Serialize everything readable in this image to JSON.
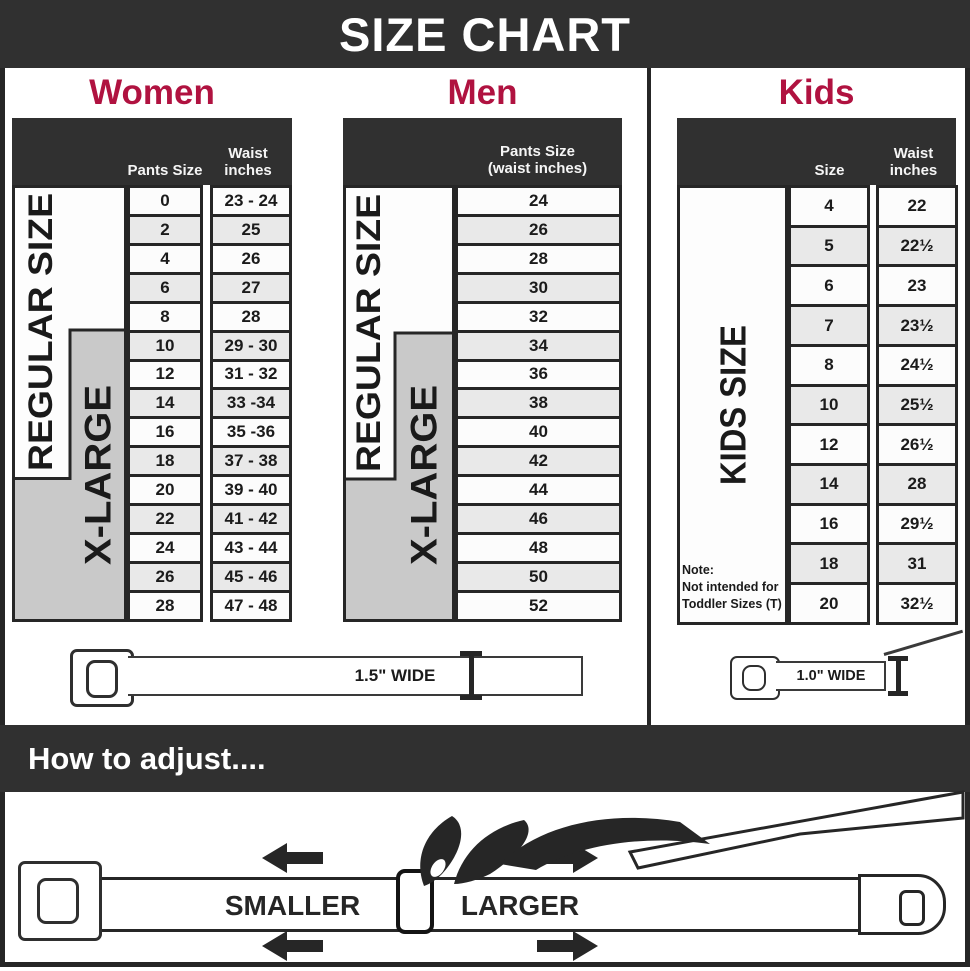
{
  "title": "SIZE CHART",
  "colors": {
    "accent_red": "#b01240",
    "band_dark": "#303030",
    "border_dark": "#262626",
    "xlarge_gray": "#c9c9c9",
    "row_alt": "#e9e9e9"
  },
  "women": {
    "heading": "Women",
    "header": {
      "col1": "Pants Size",
      "col2_line1": "Waist",
      "col2_line2": "inches"
    },
    "regular_label": "REGULAR SIZE",
    "xlarge_label": "X-LARGE",
    "rows": [
      {
        "size": "0",
        "waist": "23 - 24"
      },
      {
        "size": "2",
        "waist": "25"
      },
      {
        "size": "4",
        "waist": "26"
      },
      {
        "size": "6",
        "waist": "27"
      },
      {
        "size": "8",
        "waist": "28"
      },
      {
        "size": "10",
        "waist": "29 - 30"
      },
      {
        "size": "12",
        "waist": "31 - 32"
      },
      {
        "size": "14",
        "waist": "33 -34"
      },
      {
        "size": "16",
        "waist": "35 -36"
      },
      {
        "size": "18",
        "waist": "37 - 38"
      },
      {
        "size": "20",
        "waist": "39 - 40"
      },
      {
        "size": "22",
        "waist": "41 - 42"
      },
      {
        "size": "24",
        "waist": "43 - 44"
      },
      {
        "size": "26",
        "waist": "45 - 46"
      },
      {
        "size": "28",
        "waist": "47 - 48"
      }
    ],
    "belt_width_label": "1.5\" WIDE"
  },
  "men": {
    "heading": "Men",
    "header": {
      "line1": "Pants Size",
      "line2": "(waist inches)"
    },
    "regular_label": "REGULAR SIZE",
    "xlarge_label": "X-LARGE",
    "rows": [
      "24",
      "26",
      "28",
      "30",
      "32",
      "34",
      "36",
      "38",
      "40",
      "42",
      "44",
      "46",
      "48",
      "50",
      "52"
    ]
  },
  "kids": {
    "heading": "Kids",
    "header": {
      "col1": "Size",
      "col2_line1": "Waist",
      "col2_line2": "inches"
    },
    "side_label": "KIDS SIZE",
    "note": {
      "line1": "Note:",
      "line2": "Not intended for",
      "line3": "Toddler Sizes (T)"
    },
    "rows": [
      {
        "size": "4",
        "waist": "22"
      },
      {
        "size": "5",
        "waist": "22½"
      },
      {
        "size": "6",
        "waist": "23"
      },
      {
        "size": "7",
        "waist": "23½"
      },
      {
        "size": "8",
        "waist": "24½"
      },
      {
        "size": "10",
        "waist": "25½"
      },
      {
        "size": "12",
        "waist": "26½"
      },
      {
        "size": "14",
        "waist": "28"
      },
      {
        "size": "16",
        "waist": "29½"
      },
      {
        "size": "18",
        "waist": "31"
      },
      {
        "size": "20",
        "waist": "32½"
      }
    ],
    "belt_width_label": "1.0\" WIDE"
  },
  "adjust": {
    "heading": "How to adjust....",
    "smaller_label": "SMALLER",
    "larger_label": "LARGER"
  }
}
